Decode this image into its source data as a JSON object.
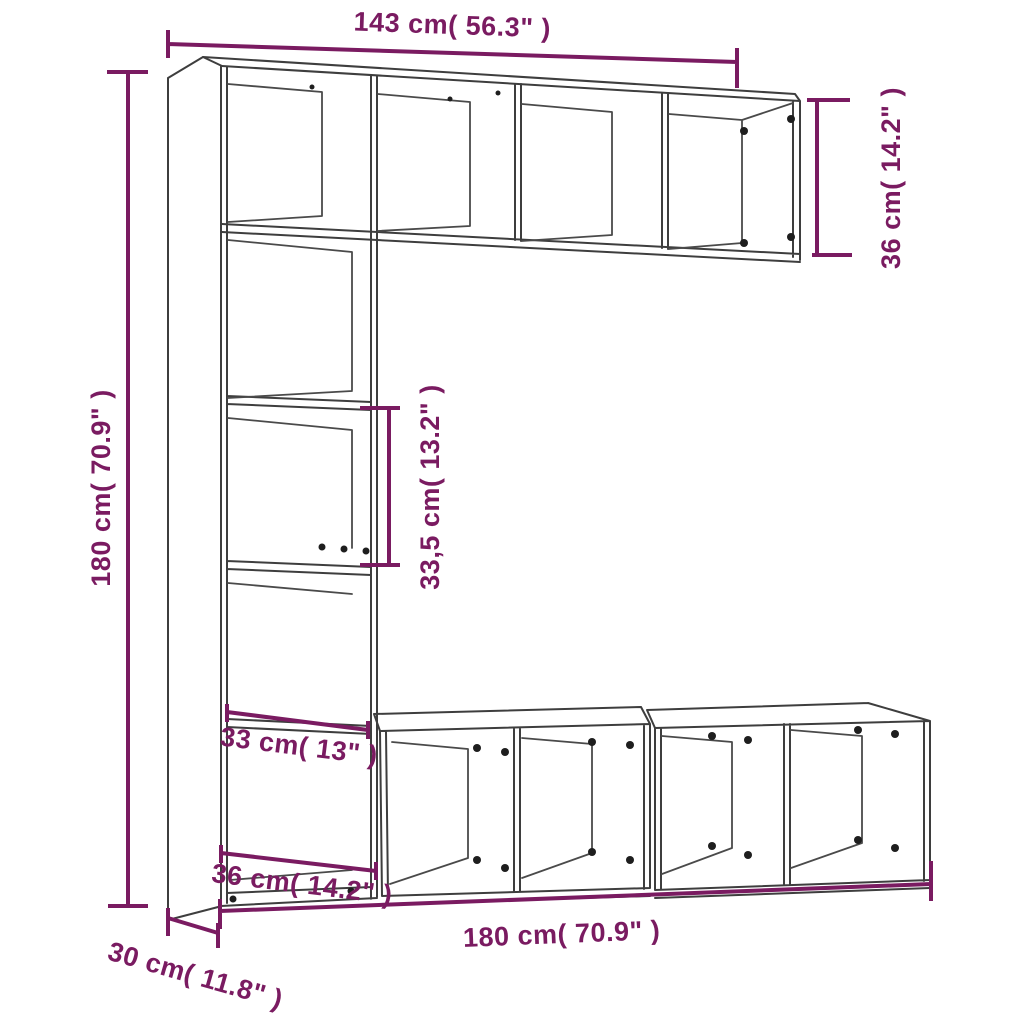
{
  "diagram": {
    "type": "furniture-dimension-diagram",
    "subject": "3-piece bookcase / TV cabinet set line drawing",
    "background_color": "#FFFFFF",
    "outline_color": "#3E3E3E",
    "dimension_color": "#7A1B61"
  },
  "dimensions": {
    "top_width": "143 cm( 56.3\" )",
    "top_unit_height": "36 cm( 14.2\" )",
    "total_height": "180 cm( 70.9\" )",
    "shelf_spacing": "33,5 cm( 13.2\" )",
    "inner_width": "33 cm( 13\" )",
    "column_width": "36 cm( 14.2\" )",
    "bottom_width": "180 cm( 70.9\" )",
    "depth": "30 cm( 11.8\" )"
  }
}
